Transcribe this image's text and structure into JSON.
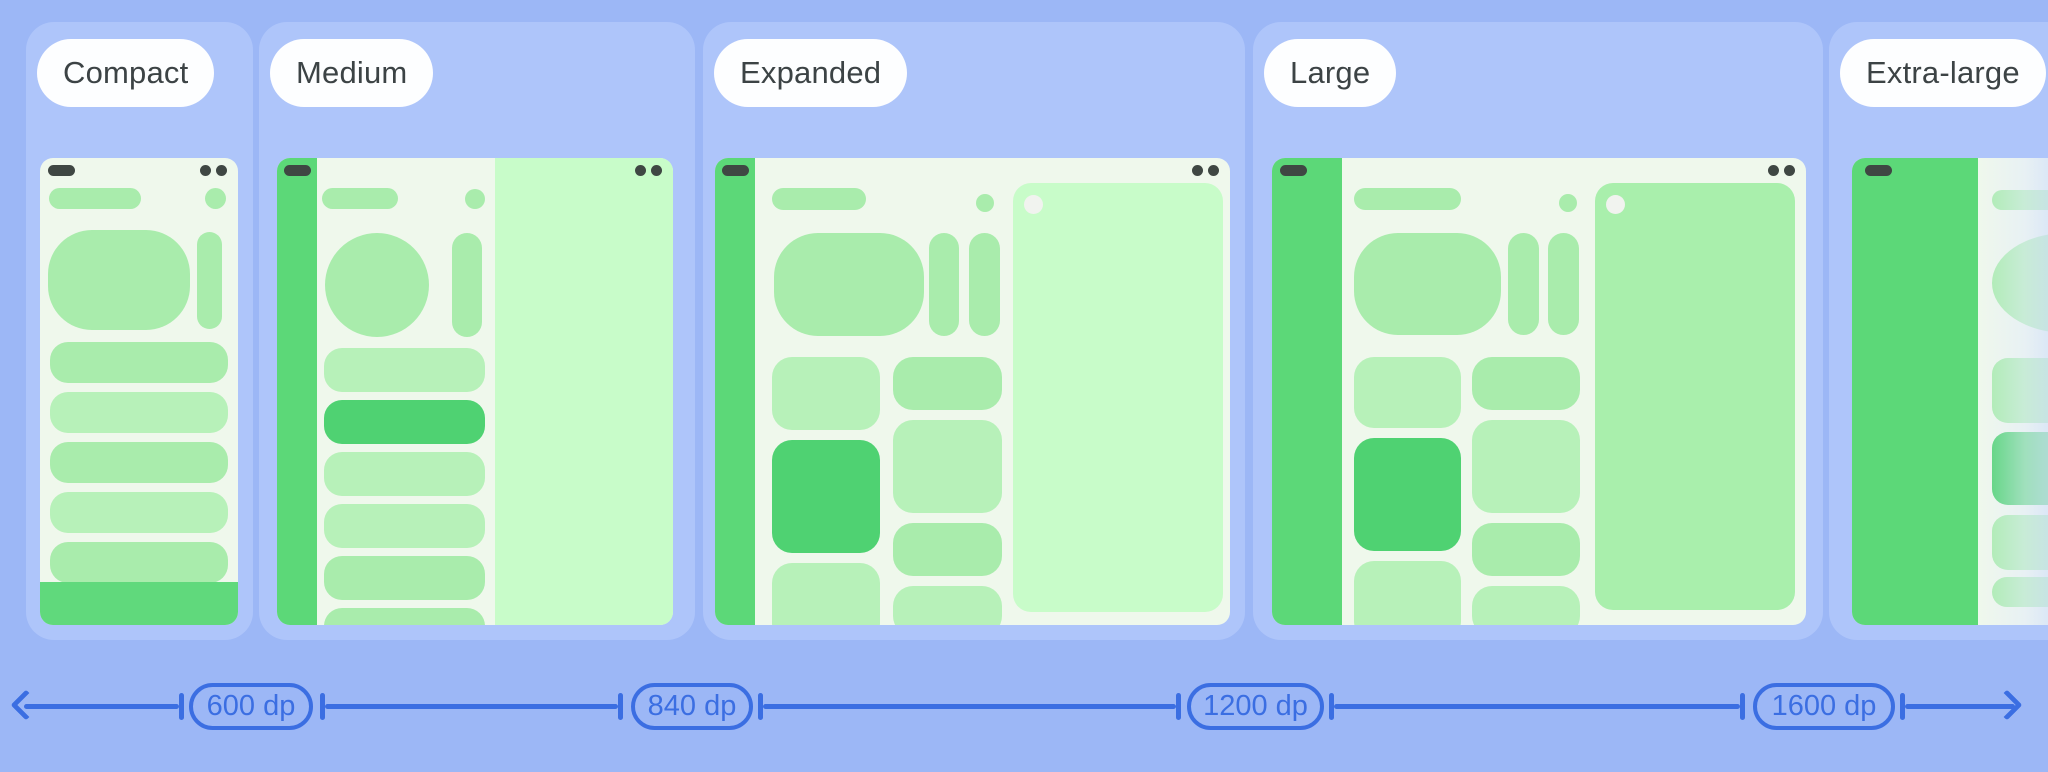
{
  "cards": [
    {
      "label": "Compact"
    },
    {
      "label": "Medium"
    },
    {
      "label": "Expanded"
    },
    {
      "label": "Large"
    },
    {
      "label": "Extra-large"
    }
  ],
  "ruler": {
    "breakpoints": [
      "600 dp",
      "840 dp",
      "1200 dp",
      "1600 dp"
    ]
  },
  "colors": {
    "page_background": "#9cb7f6",
    "card_background": "#aec5fa",
    "ruler_blue": "#3b6ee2",
    "label_text": "#3c4345",
    "screen_background": "#eff8ec",
    "rail_green": "#5cd878",
    "selected_green": "#4fd272",
    "shape_green": "#a9ecac",
    "shape_green_light": "#b7f1b9",
    "pane_mint": "#c8fcc9",
    "pane_mint_dark": "#a9efac",
    "status_dark": "#3f4743"
  }
}
